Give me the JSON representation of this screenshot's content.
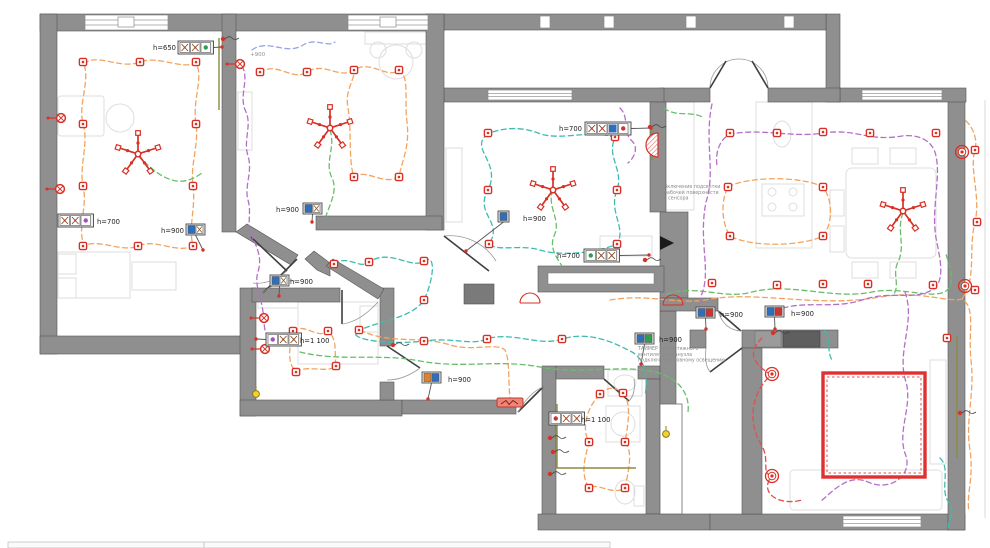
{
  "title": "apartment-electrical-plan",
  "plan": {
    "colors": {
      "wall": "#8f8f8f",
      "wall_edge": "#565656",
      "symbol": "#d93025",
      "socket_circuit": "#f2a45f",
      "light_circuit": "#3dbcae",
      "light_circuit_2": "#69bd6b",
      "circuit_purple": "#b46fc8",
      "circuit_blue": "#9aa3e8",
      "led_circuit": "#e04f4f",
      "chase": "#8a8a3f",
      "switch_blue": "#2e6fbd",
      "switch_red": "#cc3333",
      "switch_green": "#2e9e4f",
      "switch_orange": "#e0812e",
      "highlight_yellow": "#f2d230"
    },
    "labels": [
      {
        "text": "h=650",
        "x": 176,
        "y": 50,
        "anchor": "end"
      },
      {
        "text": "+900",
        "x": 250,
        "y": 56,
        "anchor": "start",
        "cls": "dim"
      },
      {
        "text": "h=700",
        "x": 97,
        "y": 224,
        "anchor": "start"
      },
      {
        "text": "h=900",
        "x": 184,
        "y": 233,
        "anchor": "end"
      },
      {
        "text": "h=900",
        "x": 299,
        "y": 212,
        "anchor": "end"
      },
      {
        "text": "h=900",
        "x": 290,
        "y": 284,
        "anchor": "start"
      },
      {
        "text": "h=700",
        "x": 582,
        "y": 131,
        "anchor": "end"
      },
      {
        "text": "h=900",
        "x": 523,
        "y": 221,
        "anchor": "start"
      },
      {
        "text": "h=700",
        "x": 580,
        "y": 258,
        "anchor": "end"
      },
      {
        "text": "h=1 100",
        "x": 300,
        "y": 343,
        "anchor": "start"
      },
      {
        "text": "h=1 100",
        "x": 581,
        "y": 422,
        "anchor": "start"
      },
      {
        "text": "h=900",
        "x": 448,
        "y": 382,
        "anchor": "start"
      },
      {
        "text": "h=900",
        "x": 659,
        "y": 342,
        "anchor": "start"
      },
      {
        "text": "h=900",
        "x": 720,
        "y": 317,
        "anchor": "start"
      },
      {
        "text": "h=900",
        "x": 791,
        "y": 316,
        "anchor": "start"
      }
    ],
    "annotations": [
      {
        "lines": [
          "Включение подсветки",
          "рабочей поверхности",
          "с сенсора"
        ],
        "x": 664,
        "y": 188
      },
      {
        "lines": [
          "ТАЙМЕР для вытяжного",
          "вентилятора санузла",
          "подключ. к основному освещению"
        ],
        "x": 638,
        "y": 350
      }
    ],
    "socket_groups": [
      {
        "x": 178,
        "y": 41,
        "cells": [
          "x",
          "x",
          "g"
        ],
        "lead": [
          222,
          47
        ]
      },
      {
        "x": 58,
        "y": 214,
        "cells": [
          "x",
          "x",
          "p"
        ],
        "lead": null
      },
      {
        "x": 585,
        "y": 122,
        "cells": [
          "x",
          "x",
          "b",
          "r"
        ],
        "lead": [
          651,
          128
        ]
      },
      {
        "x": 584,
        "y": 249,
        "cells": [
          "g",
          "x",
          "x"
        ],
        "lead": [
          649,
          255
        ]
      },
      {
        "x": 266,
        "y": 333,
        "cells": [
          "p",
          "x",
          "x"
        ],
        "lead": [
          256,
          339
        ]
      },
      {
        "x": 549,
        "y": 412,
        "cells": [
          "r",
          "x",
          "x"
        ],
        "lead": null
      }
    ],
    "switches": [
      {
        "x": 186,
        "y": 224,
        "cells": [
          "b",
          "x"
        ],
        "lead": [
          203,
          250
        ]
      },
      {
        "x": 303,
        "y": 203,
        "cells": [
          "b",
          "x"
        ],
        "lead": [
          312,
          222
        ]
      },
      {
        "x": 270,
        "y": 275,
        "cells": [
          "b",
          "x"
        ],
        "lead": [
          279,
          296
        ]
      },
      {
        "x": 498,
        "y": 211,
        "cells": [
          "b"
        ],
        "lead": [
          466,
          251
        ]
      },
      {
        "x": 422,
        "y": 372,
        "cells": [
          "o",
          "b"
        ],
        "lead": [
          428,
          399
        ]
      },
      {
        "x": 635,
        "y": 333,
        "cells": [
          "b",
          "g"
        ],
        "lead": [
          641,
          364
        ]
      },
      {
        "x": 696,
        "y": 307,
        "cells": [
          "b",
          "r"
        ],
        "lead": [
          706,
          329
        ]
      },
      {
        "x": 765,
        "y": 306,
        "cells": [
          "b",
          "r"
        ],
        "lead": [
          775,
          329
        ]
      }
    ],
    "sockets": [
      [
        83,
        62
      ],
      [
        140,
        62
      ],
      [
        196,
        62
      ],
      [
        83,
        124
      ],
      [
        196,
        124
      ],
      [
        83,
        186
      ],
      [
        193,
        186
      ],
      [
        83,
        246
      ],
      [
        138,
        246
      ],
      [
        193,
        246
      ],
      [
        260,
        72
      ],
      [
        307,
        72
      ],
      [
        354,
        70
      ],
      [
        399,
        70
      ],
      [
        354,
        177
      ],
      [
        399,
        177
      ],
      [
        293,
        331
      ],
      [
        328,
        331
      ],
      [
        296,
        372
      ],
      [
        336,
        366
      ],
      [
        488,
        133
      ],
      [
        488,
        190
      ],
      [
        489,
        244
      ],
      [
        615,
        137
      ],
      [
        617,
        190
      ],
      [
        617,
        244
      ],
      [
        334,
        264
      ],
      [
        369,
        262
      ],
      [
        424,
        261
      ],
      [
        424,
        300
      ],
      [
        359,
        330
      ],
      [
        424,
        341
      ],
      [
        487,
        339
      ],
      [
        562,
        339
      ],
      [
        728,
        187
      ],
      [
        823,
        187
      ],
      [
        730,
        236
      ],
      [
        823,
        236
      ],
      [
        712,
        283
      ],
      [
        777,
        285
      ],
      [
        823,
        284
      ],
      [
        868,
        284
      ],
      [
        933,
        285
      ],
      [
        730,
        133
      ],
      [
        777,
        133
      ],
      [
        823,
        132
      ],
      [
        870,
        133
      ],
      [
        936,
        133
      ],
      [
        600,
        394
      ],
      [
        623,
        393
      ],
      [
        589,
        442
      ],
      [
        625,
        442
      ],
      [
        589,
        488
      ],
      [
        625,
        488
      ],
      [
        975,
        150
      ],
      [
        977,
        222
      ],
      [
        975,
        290
      ],
      [
        947,
        338
      ]
    ],
    "chandeliers": [
      [
        138,
        154
      ],
      [
        330,
        128
      ],
      [
        553,
        190
      ],
      [
        903,
        211
      ]
    ],
    "sconces": [
      [
        61,
        118
      ],
      [
        60,
        189
      ],
      [
        240,
        64
      ],
      [
        264,
        318
      ],
      [
        265,
        349
      ]
    ],
    "rings": [
      [
        772,
        374
      ],
      [
        772,
        476
      ],
      [
        962,
        152
      ],
      [
        965,
        286
      ]
    ],
    "red_dots": [
      [
        223,
        39
      ],
      [
        393,
        345
      ],
      [
        645,
        260
      ],
      [
        650,
        127
      ],
      [
        960,
        413
      ],
      [
        773,
        333
      ],
      [
        550,
        438
      ],
      [
        553,
        452
      ],
      [
        550,
        474
      ]
    ],
    "yellow_dots": [
      [
        666,
        434
      ],
      [
        256,
        394
      ]
    ],
    "red_arcs": [
      [
        530,
        303,
        10
      ],
      [
        673,
        305,
        10
      ]
    ],
    "fan": {
      "x": 497,
      "y": 398,
      "w": 26,
      "h": 9
    },
    "heater": {
      "cx": 658,
      "cy": 145,
      "r": 12
    },
    "led_zone": {
      "x": 823,
      "y": 373,
      "w": 102,
      "h": 104
    },
    "chases": [
      "M219,38 L219,110",
      "M957,336 L957,458",
      "M557,404 L557,468 L636,468",
      "M652,130 L652,160"
    ],
    "cables": [
      {
        "circuit": "socket_circuit",
        "d": "M84,64 C96,52 120,70 140,62 C158,55 182,70 196,63 C204,78 192,100 196,124 C199,145 190,165 193,186 C196,208 188,226 193,246 C176,254 156,238 138,246 C122,253 98,238 84,246 C77,226 88,206 83,186 C79,165 89,144 83,124 C78,104 90,82 84,64"
      },
      {
        "circuit": "socket_circuit",
        "d": "M260,73 C276,60 292,82 307,72 C324,61 340,80 354,70 C370,59 388,80 399,70 C410,77 404,100 407,122 C410,147 402,160 399,177 C384,186 366,168 354,177 C348,160 352,130 348,108 C345,92 352,84 354,74"
      },
      {
        "circuit": "socket_circuit",
        "d": "M293,331 C304,322 318,340 328,331 C338,340 334,352 336,366 C326,374 308,364 296,372 C286,362 290,345 293,331"
      },
      {
        "circuit": "socket_circuit",
        "d": "M728,187 C748,176 802,176 823,187 C833,200 833,224 823,236 C800,247 750,247 730,236 C721,222 721,200 728,187"
      },
      {
        "circuit": "socket_circuit",
        "d": "M610,300 C650,293 680,306 710,299 C760,291 820,308 880,297 C920,290 948,303 962,299 C976,308 968,330 971,360 C975,395 965,420 970,450 C974,478 966,495 969,512"
      },
      {
        "circuit": "socket_circuit",
        "d": "M962,299 C977,278 968,250 975,222 C981,196 969,170 975,150 C978,138 972,126 965,120"
      },
      {
        "circuit": "socket_circuit",
        "d": "M600,394 C608,386 616,387 623,393 C631,402 629,420 625,442 C633,452 629,468 625,488 C612,496 598,482 589,488 C580,474 585,458 589,442 C582,430 585,410 600,394"
      },
      {
        "circuit": "socket_circuit",
        "d": "M360,330 C390,345 420,335 450,345 C475,352 495,342 505,350 C510,360 508,380 510,398"
      },
      {
        "circuit": "light_circuit",
        "d": "M488,134 C468,148 502,162 488,190 C474,214 504,222 489,244 C498,252 520,244 540,250 C562,257 600,252 617,244 C627,228 608,212 617,190 C624,170 606,156 615,138 C594,128 560,142 538,133 C520,126 500,128 488,134"
      },
      {
        "circuit": "light_circuit",
        "d": "M334,264 C348,254 360,270 369,262 C390,248 412,270 424,261 C438,252 432,284 424,300 C412,318 382,320 360,330 C342,337 380,346 424,341 C456,337 470,346 487,339 C512,331 540,347 562,339 C592,330 618,345 632,352 C646,360 648,378 645,396"
      },
      {
        "circuit": "light_circuit",
        "d": "M940,458 C952,470 938,490 950,504 C956,514 946,522 949,528"
      },
      {
        "circuit": "light_circuit",
        "d": "M824,330 C832,340 826,350 832,360"
      },
      {
        "circuit": "light_circuit_2",
        "d": "M138,156 C148,165 158,176 172,180 C184,184 196,178 203,172"
      },
      {
        "circuit": "light_circuit_2",
        "d": "M330,130 C336,148 324,162 332,178 C338,190 330,204 326,216"
      },
      {
        "circuit": "light_circuit_2",
        "d": "M553,190 C546,206 562,220 554,236 C549,248 557,258 562,266"
      },
      {
        "circuit": "light_circuit_2",
        "d": "M300,352 C340,362 380,353 420,361 C462,369 500,359 540,367 C580,375 622,364 655,372 C680,378 690,395 688,412"
      },
      {
        "circuit": "light_circuit_2",
        "d": "M667,294 C700,284 722,300 752,292 C792,282 832,300 872,292 C902,286 932,300 946,291 C956,284 950,268 946,254"
      },
      {
        "circuit": "light_circuit_2",
        "d": "M903,213 C896,230 906,246 898,262 C892,274 900,284 894,294"
      },
      {
        "circuit": "light_circuit_2",
        "d": "M664,108 C676,118 692,110 704,118"
      },
      {
        "circuit": "circuit_purple",
        "d": "M242,66 C250,80 238,96 246,112 C252,126 243,140 248,156 C253,172 244,186 248,200 C252,214 246,224 252,236 C258,250 262,258 258,272 C254,284 261,296 263,312 C265,324 263,330 268,336"
      },
      {
        "circuit": "circuit_purple",
        "d": "M712,104 C704,142 716,172 706,202 C698,242 712,272 701,296 C697,308 703,315 707,313 M775,311 C802,299 832,310 862,300 C892,290 912,301 932,290 C946,282 940,258 936,238 C931,208 941,180 936,156 C933,140 918,134 902,136 C868,142 856,128 823,133 C792,138 762,128 731,134 C720,138 715,152 717,166"
      },
      {
        "circuit": "circuit_purple",
        "d": "M905,292 C916,322 896,352 906,382 C913,407 896,432 906,456 C912,476 890,492 868,482 C848,473 832,492 820,502"
      },
      {
        "circuit": "circuit_purple",
        "d": "M620,108 C630,118 622,132 632,141 C639,148 634,158 628,163"
      },
      {
        "circuit": "circuit_blue",
        "d": "M252,50 C268,38 286,56 303,45 C316,37 327,48 335,42"
      },
      {
        "circuit": "led_circuit",
        "d": "M762,338 C744,356 758,366 771,375 C751,393 747,422 762,446 C770,461 761,470 771,477 C759,494 780,506 802,500"
      }
    ],
    "title_block": {
      "cells": [
        {
          "x": 8,
          "y": 542,
          "w": 196,
          "h": 6
        },
        {
          "x": 204,
          "y": 542,
          "w": 406,
          "h": 6
        }
      ]
    }
  }
}
